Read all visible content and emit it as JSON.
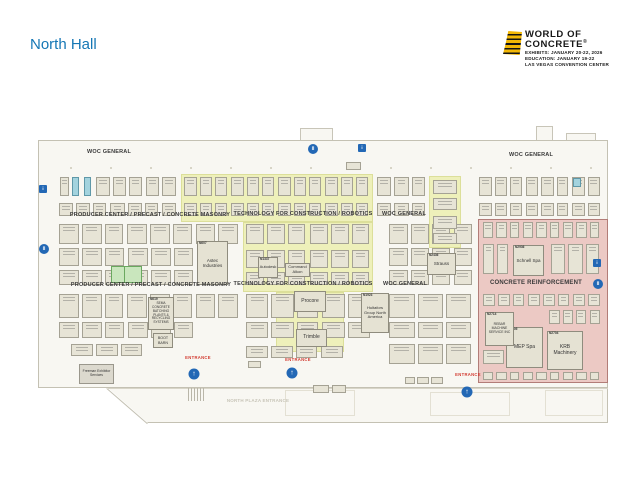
{
  "title": "North Hall",
  "logo": {
    "title_line1": "WORLD OF",
    "title_line2": "CONCRETE",
    "registered": "®",
    "info_lines": [
      "EXHIBITS: JANUARY 20-22, 2026",
      "EDUCATION: JANUARY 19-22",
      "LAS VEGAS CONVENTION CENTER"
    ]
  },
  "colors": {
    "accent_blue": "#1577b5",
    "entrance_red": "#d23a30",
    "zone_yellow": "#eef0ba",
    "zone_pink": "#ecc9c4",
    "booth_fill": "#e7e4d6",
    "teal_booth": "#a3d3de",
    "green_booth": "#c9e6bd",
    "icon_blue": "#2368b5",
    "logo_yellow": "#f2b705"
  },
  "map": {
    "section_labels": [
      {
        "text": "WOC GENERAL",
        "x": 109,
        "y": 152,
        "size": 5.5
      },
      {
        "text": "WOC GENERAL",
        "x": 531,
        "y": 155,
        "size": 5.5
      },
      {
        "text": "PRODUCER CENTER / PRECAST / CONCRETE MASONRY",
        "x": 150,
        "y": 214.5,
        "size": 5.5
      },
      {
        "text": "TECHNOLOGY FOR CONSTRUCTION / ROBOTICS",
        "x": 303,
        "y": 213.5,
        "size": 5.5
      },
      {
        "text": "WOC GENERAL",
        "x": 404,
        "y": 214,
        "size": 5.5
      },
      {
        "text": "PRODUCER CENTER / PRECAST / CONCRETE MASONRY",
        "x": 151,
        "y": 284.5,
        "size": 5.5
      },
      {
        "text": "TECHNOLOGY FOR CONSTRUCTION / ROBOTICS",
        "x": 303,
        "y": 283.5,
        "size": 5.5
      },
      {
        "text": "WOC GENERAL",
        "x": 405,
        "y": 284,
        "size": 5.5
      },
      {
        "text": "CONCRETE REINFORCEMENT",
        "x": 536,
        "y": 282.5,
        "size": 6
      },
      {
        "text": "NORTH PLAZA ENTRANCE",
        "x": 258,
        "y": 400.5,
        "size": 4.5,
        "muted": true
      }
    ],
    "zones": [
      {
        "name": "technology-for-construction-robotics-upper",
        "type": "yellow",
        "x": 181,
        "y": 174,
        "w": 192,
        "h": 48
      },
      {
        "name": "technology-for-construction-robotics-mid",
        "type": "yellow",
        "x": 243,
        "y": 222,
        "w": 130,
        "h": 70
      },
      {
        "name": "technology-for-construction-robotics-lower",
        "type": "yellow",
        "x": 276,
        "y": 292,
        "w": 68,
        "h": 60
      },
      {
        "name": "technology-for-construction-robotics-right",
        "type": "yellow",
        "x": 429,
        "y": 176,
        "w": 32,
        "h": 72
      },
      {
        "name": "concrete-reinforcement",
        "type": "pink",
        "x": 478,
        "y": 219,
        "w": 130,
        "h": 164
      }
    ],
    "named_booths": [
      {
        "num": "N607",
        "name": "Astec Industries",
        "x": 197,
        "y": 241,
        "w": 31,
        "h": 44,
        "fs": 4.5
      },
      {
        "num": "N619",
        "name": "SEMA CONCRETE BATCHING PLANTS & RECYCLING SYSTEMS",
        "x": 148,
        "y": 297,
        "w": 26,
        "h": 33,
        "fs": 3.2
      },
      {
        "name": "BOOT BARN",
        "x": 153,
        "y": 333,
        "w": 20,
        "h": 15,
        "fs": 3.6
      },
      {
        "num": "N1337",
        "name": "Autodesk",
        "x": 258,
        "y": 257,
        "w": 20,
        "h": 21,
        "fs": 4
      },
      {
        "name": "Command Alkon",
        "x": 285,
        "y": 263,
        "w": 25,
        "h": 14,
        "fs": 4
      },
      {
        "name": "Procore",
        "x": 294,
        "y": 291,
        "w": 32,
        "h": 21,
        "fs": 5
      },
      {
        "name": "Trimble",
        "x": 296,
        "y": 329,
        "w": 31,
        "h": 18,
        "fs": 5
      },
      {
        "num": "N1923",
        "name": "Hultafors Group North America",
        "x": 361,
        "y": 293,
        "w": 28,
        "h": 40,
        "fs": 4
      },
      {
        "num": "N2436",
        "name": "Strauss",
        "x": 427,
        "y": 253,
        "w": 29,
        "h": 22,
        "fs": 4.5
      },
      {
        "num": "N2936",
        "name": "Schnell Spa",
        "x": 513,
        "y": 245,
        "w": 31,
        "h": 31,
        "fs": 4.5
      },
      {
        "num": "N2805",
        "name": "MEP Spa",
        "x": 506,
        "y": 327,
        "w": 37,
        "h": 41,
        "fs": 5
      },
      {
        "num": "N2704",
        "name": "KRB Machinery",
        "x": 547,
        "y": 331,
        "w": 36,
        "h": 39,
        "fs": 5
      },
      {
        "num": "N2714",
        "name": "REBAR MACHINE SERVICE INC",
        "x": 485,
        "y": 312,
        "w": 29,
        "h": 34,
        "fs": 3.4
      },
      {
        "name": "Freeman Exhibitor Services",
        "x": 79,
        "y": 364,
        "w": 35,
        "h": 20,
        "fs": 3.4,
        "variant": "gray"
      }
    ],
    "entrance_label": "ENTRANCE",
    "entrances": [
      {
        "tx": 198,
        "ty": 357,
        "ix": 194,
        "iy": 374
      },
      {
        "tx": 298,
        "ty": 359,
        "ix": 292,
        "iy": 373
      },
      {
        "tx": 468,
        "ty": 374,
        "ix": 467,
        "iy": 392
      }
    ],
    "facility_icons": [
      {
        "shape": "square",
        "x": 43,
        "y": 189
      },
      {
        "shape": "circle",
        "x": 44,
        "y": 249
      },
      {
        "shape": "circle",
        "x": 313,
        "y": 149
      },
      {
        "shape": "square",
        "x": 362,
        "y": 148
      },
      {
        "shape": "square",
        "x": 597,
        "y": 263
      },
      {
        "shape": "circle",
        "x": 598,
        "y": 284
      }
    ],
    "booth_bands": [
      {
        "x": 95,
        "x2": 178,
        "y": 177,
        "h": 19,
        "n": 5
      },
      {
        "x": 58,
        "x2": 178,
        "y": 203,
        "h": 13,
        "n": 7
      },
      {
        "x": 183,
        "x2": 371,
        "y": 177,
        "h": 19,
        "n": 12
      },
      {
        "x": 183,
        "x2": 371,
        "y": 203,
        "h": 13,
        "n": 12
      },
      {
        "x": 376,
        "x2": 428,
        "y": 177,
        "h": 19,
        "n": 3
      },
      {
        "x": 376,
        "x2": 428,
        "y": 203,
        "h": 13,
        "n": 3
      },
      {
        "x": 478,
        "x2": 602,
        "y": 177,
        "h": 19,
        "n": 8
      },
      {
        "x": 478,
        "x2": 602,
        "y": 203,
        "h": 13,
        "n": 8
      },
      {
        "x": 58,
        "x2": 240,
        "y": 224,
        "h": 20,
        "n": 8
      },
      {
        "x": 58,
        "x2": 196,
        "y": 248,
        "h": 18,
        "n": 6
      },
      {
        "x": 58,
        "x2": 196,
        "y": 270,
        "h": 15,
        "n": 6
      },
      {
        "x": 245,
        "x2": 372,
        "y": 224,
        "h": 20,
        "n": 6
      },
      {
        "x": 245,
        "x2": 372,
        "y": 250,
        "h": 18,
        "n": 6
      },
      {
        "x": 245,
        "x2": 372,
        "y": 272,
        "h": 13,
        "n": 6
      },
      {
        "x": 388,
        "x2": 474,
        "y": 224,
        "h": 20,
        "n": 4
      },
      {
        "x": 388,
        "x2": 474,
        "y": 248,
        "h": 18,
        "n": 4
      },
      {
        "x": 388,
        "x2": 474,
        "y": 270,
        "h": 15,
        "n": 4
      },
      {
        "x": 58,
        "x2": 240,
        "y": 294,
        "h": 24,
        "n": 8
      },
      {
        "x": 58,
        "x2": 196,
        "y": 322,
        "h": 16,
        "n": 6
      },
      {
        "x": 70,
        "x2": 145,
        "y": 344,
        "h": 12,
        "n": 3
      },
      {
        "x": 245,
        "x2": 372,
        "y": 294,
        "h": 24,
        "n": 5
      },
      {
        "x": 245,
        "x2": 372,
        "y": 322,
        "h": 16,
        "n": 5
      },
      {
        "x": 245,
        "x2": 345,
        "y": 346,
        "h": 12,
        "n": 4
      },
      {
        "x": 388,
        "x2": 474,
        "y": 294,
        "h": 24,
        "n": 3
      },
      {
        "x": 388,
        "x2": 474,
        "y": 322,
        "h": 16,
        "n": 3
      },
      {
        "x": 388,
        "x2": 474,
        "y": 344,
        "h": 20,
        "n": 3
      },
      {
        "x": 482,
        "x2": 602,
        "y": 222,
        "h": 16,
        "n": 9
      },
      {
        "x": 482,
        "x2": 510,
        "y": 244,
        "h": 30,
        "n": 2
      },
      {
        "x": 550,
        "x2": 602,
        "y": 244,
        "h": 30,
        "n": 3
      },
      {
        "x": 482,
        "x2": 602,
        "y": 294,
        "h": 12,
        "n": 8
      },
      {
        "x": 548,
        "x2": 602,
        "y": 310,
        "h": 14,
        "n": 4
      },
      {
        "x": 482,
        "x2": 506,
        "y": 350,
        "h": 14,
        "n": 1
      },
      {
        "x": 482,
        "x2": 602,
        "y": 372,
        "h": 8,
        "n": 9
      }
    ],
    "extra_booths": [
      {
        "x": 60,
        "y": 177,
        "w": 9,
        "h": 19
      },
      {
        "x": 72,
        "y": 177,
        "w": 7,
        "h": 19,
        "variant": "teal"
      },
      {
        "x": 84,
        "y": 177,
        "w": 7,
        "h": 19,
        "variant": "teal"
      },
      {
        "x": 573,
        "y": 178,
        "w": 8,
        "h": 9,
        "variant": "teal"
      },
      {
        "x": 111,
        "y": 266,
        "w": 31,
        "h": 17,
        "variant": "green"
      },
      {
        "x": 433,
        "y": 180,
        "w": 24,
        "h": 14
      },
      {
        "x": 433,
        "y": 198,
        "w": 24,
        "h": 12
      },
      {
        "x": 433,
        "y": 216,
        "w": 24,
        "h": 13
      },
      {
        "x": 433,
        "y": 233,
        "w": 24,
        "h": 11
      },
      {
        "x": 346,
        "y": 162,
        "w": 15,
        "h": 8
      },
      {
        "x": 248,
        "y": 361,
        "w": 13,
        "h": 7
      },
      {
        "x": 313,
        "y": 385,
        "w": 16,
        "h": 8
      },
      {
        "x": 332,
        "y": 385,
        "w": 14,
        "h": 8
      },
      {
        "x": 405,
        "y": 377,
        "w": 10,
        "h": 7
      },
      {
        "x": 417,
        "y": 377,
        "w": 12,
        "h": 7
      },
      {
        "x": 431,
        "y": 377,
        "w": 12,
        "h": 7
      }
    ],
    "structures": {
      "rooms": [
        {
          "x": 300,
          "y": 128,
          "w": 33,
          "h": 13
        },
        {
          "x": 536,
          "y": 126,
          "w": 17,
          "h": 15
        },
        {
          "x": 566,
          "y": 133,
          "w": 30,
          "h": 8
        }
      ],
      "lobbies": [
        {
          "x": 285,
          "y": 390,
          "w": 70,
          "h": 26
        },
        {
          "x": 430,
          "y": 392,
          "w": 80,
          "h": 24
        },
        {
          "x": 545,
          "y": 390,
          "w": 58,
          "h": 26
        }
      ],
      "stairs": {
        "x": 188,
        "y": 388,
        "w": 16,
        "h": 13
      },
      "divider_line": {
        "x": 108,
        "y": 388,
        "w": 500,
        "h": 1
      }
    }
  }
}
